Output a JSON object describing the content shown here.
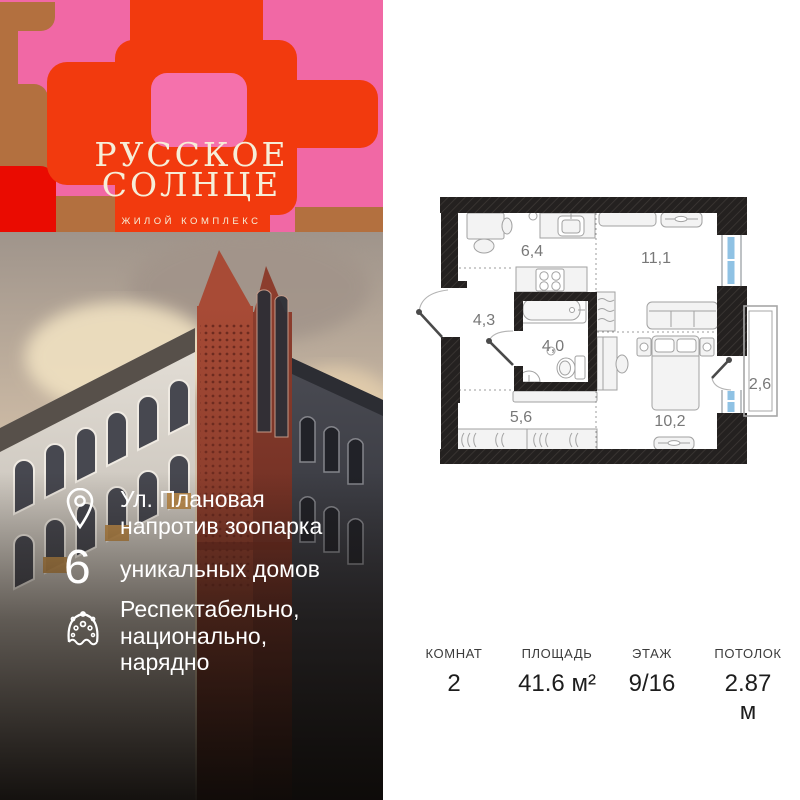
{
  "brand": {
    "name_line1": "РУССКОЕ",
    "name_line2": "СОЛНЦЕ",
    "tagline": "ЖИЛОЙ КОМПЛЕКС",
    "colors": {
      "pink": "#f168a5",
      "orange": "#f23a0e",
      "brown": "#b3703f",
      "red": "#ea0b01",
      "cream": "#f6eed8"
    }
  },
  "highlights": [
    {
      "icon": "map-pin-icon",
      "lines": [
        "Ул. Плановая",
        "напротив зоопарка"
      ]
    },
    {
      "icon": "six-numeral",
      "numeral": "6",
      "lines": [
        "уникальных домов"
      ]
    },
    {
      "icon": "kokoshnik-icon",
      "lines": [
        "Респектабельно,",
        "национально,",
        "нарядно"
      ]
    }
  ],
  "floor_plan": {
    "rooms": [
      {
        "name": "kitchen",
        "area_label": "6,4"
      },
      {
        "name": "living-room",
        "area_label": "11,1"
      },
      {
        "name": "hallway",
        "area_label": "4,3"
      },
      {
        "name": "bathroom",
        "area_label": "4,0"
      },
      {
        "name": "storage",
        "area_label": "5,6"
      },
      {
        "name": "bedroom",
        "area_label": "10,2"
      },
      {
        "name": "balcony",
        "area_label": "2,6"
      }
    ]
  },
  "stats": {
    "columns": [
      {
        "label": "КОМНАТ",
        "value": "2"
      },
      {
        "label": "ПЛОЩАДЬ",
        "value": "41.6 м²"
      },
      {
        "label": "ЭТАЖ",
        "value": "9/16"
      },
      {
        "label": "ПОТОЛОК",
        "value": "2.87 м"
      }
    ]
  }
}
